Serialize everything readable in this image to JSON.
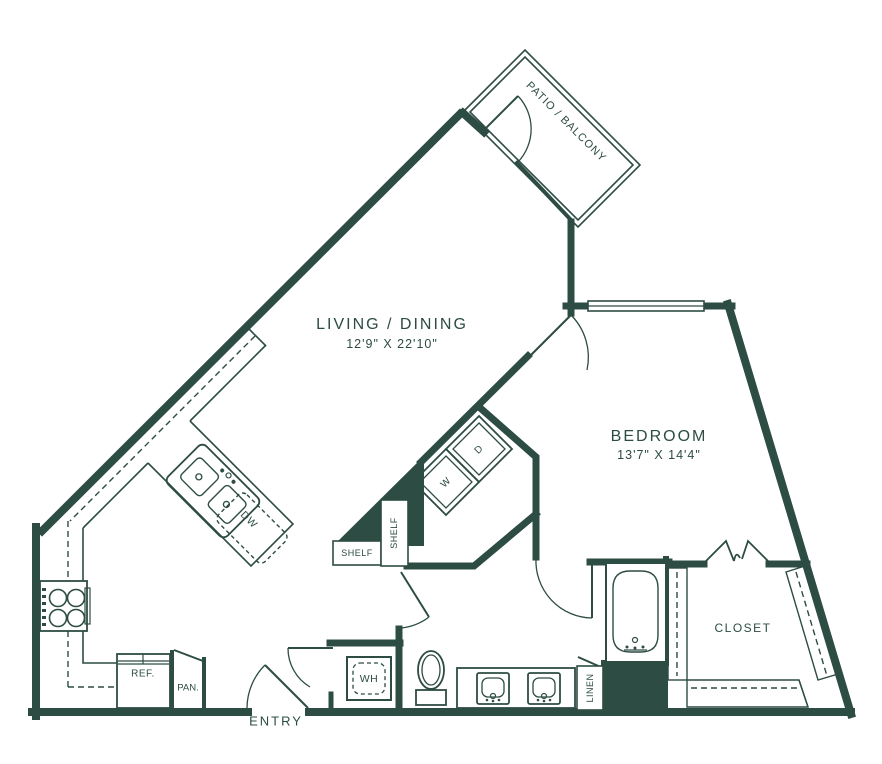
{
  "plan": {
    "wall_color": "#2d4c43",
    "labels": {
      "living_dining": {
        "name": "LIVING / DINING",
        "dims": "12'9\" X 22'10\""
      },
      "bedroom": {
        "name": "BEDROOM",
        "dims": "13'7\" X 14'4\""
      },
      "patio_balcony": {
        "name": "PATIO / BALCONY"
      },
      "closet": {
        "name": "CLOSET"
      },
      "entry": {
        "name": "ENTRY"
      },
      "shelf_horizontal": "SHELF",
      "shelf_vertical": "SHELF",
      "washer": "W",
      "dryer": "D",
      "dishwasher": "DW",
      "water_heater": "WH",
      "refrigerator": "REF.",
      "pantry": "PAN.",
      "linen": "LINEN"
    }
  }
}
